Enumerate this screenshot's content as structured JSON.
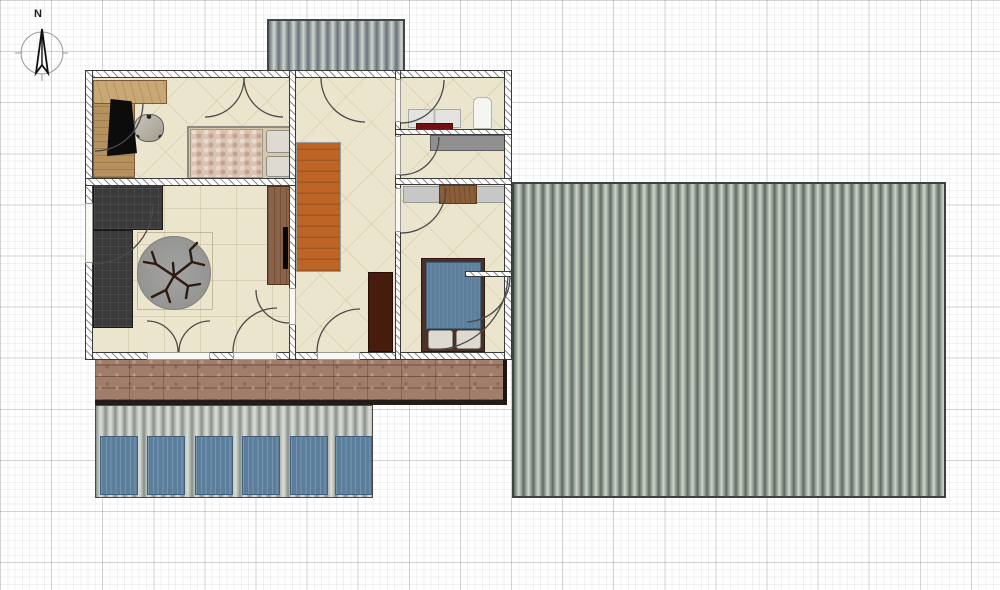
{
  "compass": {
    "north_label": "N"
  },
  "palette": {
    "grid_minor": "#ececec",
    "grid_major": "#d6d6d6",
    "floor": "#ece5cd",
    "wall_fill": "#ffffff",
    "wall_outline": "#3a3a3a",
    "roof_dark": "#5d6a64",
    "roof_light": "#cfd4c6",
    "deck_wood": "#a07e6b",
    "stairs_orange": "#bc6527",
    "sofa_charcoal": "#3b3b3b",
    "rug_gray": "#9a9a98",
    "bed1_mottle": "#d9c3b2",
    "bed2_blue": "#5d7f9b",
    "bed2_frame": "#4a3026",
    "wardrobe_brown": "#451c0e",
    "sideboard_brown": "#8b6349",
    "desk_tan": "#c9a876",
    "accent_dark_red": "#701014",
    "carport_panel_blue": "#5b7e9c"
  },
  "plan": {
    "structures": [
      {
        "name": "porch-roof-corrugated",
        "cls": "corrugated-a",
        "x": 267,
        "y": 19,
        "w": 138,
        "h": 54
      },
      {
        "name": "main-roof-corrugated",
        "cls": "corrugated-b",
        "x": 512,
        "y": 182,
        "w": 434,
        "h": 316
      },
      {
        "name": "deck-boards",
        "cls": "deck",
        "x": 95,
        "y": 358,
        "w": 412,
        "h": 47
      },
      {
        "name": "carport-roof-corrugated",
        "cls": "corrugated-c",
        "x": 95,
        "y": 405,
        "w": 278,
        "h": 93
      },
      {
        "name": "carport-panel",
        "cls": "blue-panel",
        "x": 100,
        "y": 436,
        "w": 38,
        "h": 59
      },
      {
        "name": "carport-panel",
        "cls": "blue-panel",
        "x": 147,
        "y": 436,
        "w": 38,
        "h": 59
      },
      {
        "name": "carport-panel",
        "cls": "blue-panel",
        "x": 195,
        "y": 436,
        "w": 38,
        "h": 59
      },
      {
        "name": "carport-panel",
        "cls": "blue-panel",
        "x": 242,
        "y": 436,
        "w": 38,
        "h": 59
      },
      {
        "name": "carport-panel",
        "cls": "blue-panel",
        "x": 290,
        "y": 436,
        "w": 38,
        "h": 59
      },
      {
        "name": "carport-panel",
        "cls": "blue-panel",
        "x": 335,
        "y": 436,
        "w": 37,
        "h": 59
      }
    ],
    "rooms": [
      {
        "name": "room-bedroom-office",
        "cls": "room room-diag",
        "x": 92,
        "y": 77,
        "w": 198,
        "h": 104
      },
      {
        "name": "room-living",
        "cls": "room room-grid",
        "x": 92,
        "y": 186,
        "w": 198,
        "h": 167
      },
      {
        "name": "room-hallway",
        "cls": "room room-diag",
        "x": 296,
        "y": 77,
        "w": 100,
        "h": 276
      },
      {
        "name": "room-bathroom",
        "cls": "room room-diag",
        "x": 401,
        "y": 77,
        "w": 104,
        "h": 53
      },
      {
        "name": "room-utility",
        "cls": "room room-diag",
        "x": 401,
        "y": 135,
        "w": 104,
        "h": 44
      },
      {
        "name": "room-bedroom-2",
        "cls": "room room-diag",
        "x": 401,
        "y": 184,
        "w": 104,
        "h": 169
      }
    ],
    "furniture": [
      {
        "name": "desk-return",
        "cls": "desk",
        "x": 93,
        "y": 80,
        "w": 42,
        "h": 98
      },
      {
        "name": "desk-top",
        "cls": "desk-light",
        "x": 93,
        "y": 80,
        "w": 74,
        "h": 24
      },
      {
        "name": "chair-mat",
        "cls": "mat",
        "x": 107,
        "y": 99,
        "w": 30,
        "h": 57
      },
      {
        "name": "office-chair",
        "cls": "chair",
        "x": 134,
        "y": 114,
        "w": 30,
        "h": 28
      },
      {
        "name": "bed-double-frame",
        "cls": "bed1",
        "x": 187,
        "y": 126,
        "w": 108,
        "h": 55
      },
      {
        "name": "bed-double-duvet",
        "cls": "mottle",
        "x": 190,
        "y": 129,
        "w": 73,
        "h": 49
      },
      {
        "name": "bed-pillow",
        "cls": "pillow",
        "x": 266,
        "y": 130,
        "w": 25,
        "h": 23
      },
      {
        "name": "bed-pillow",
        "cls": "pillow",
        "x": 266,
        "y": 156,
        "w": 25,
        "h": 21
      },
      {
        "name": "sofa-chaise",
        "cls": "sofa",
        "x": 93,
        "y": 182,
        "w": 70,
        "h": 48
      },
      {
        "name": "sofa-main",
        "cls": "sofa",
        "x": 93,
        "y": 230,
        "w": 40,
        "h": 98
      },
      {
        "name": "rug-border",
        "cls": "rug-square",
        "x": 137,
        "y": 232,
        "w": 76,
        "h": 78
      },
      {
        "name": "round-rug",
        "cls": "rug",
        "x": 137,
        "y": 236,
        "w": 74,
        "h": 74
      },
      {
        "name": "sideboard",
        "cls": "sideboard",
        "x": 267,
        "y": 186,
        "w": 23,
        "h": 99
      },
      {
        "name": "tv-screen",
        "cls": "tv",
        "x": 283,
        "y": 227,
        "w": 5,
        "h": 42
      },
      {
        "name": "staircase",
        "cls": "stairs",
        "x": 296,
        "y": 142,
        "w": 45,
        "h": 130
      },
      {
        "name": "wardrobe",
        "cls": "wardrobe",
        "x": 368,
        "y": 272,
        "w": 25,
        "h": 80
      },
      {
        "name": "vanity-cabinet",
        "cls": "vanity",
        "x": 408,
        "y": 109,
        "w": 53,
        "h": 19
      },
      {
        "name": "bath-mat-red",
        "cls": "red-accent",
        "x": 416,
        "y": 123,
        "w": 37,
        "h": 8
      },
      {
        "name": "shower-cabinet",
        "cls": "white-box",
        "x": 473,
        "y": 97,
        "w": 19,
        "h": 32
      },
      {
        "name": "utility-counter",
        "cls": "counter",
        "x": 430,
        "y": 135,
        "w": 77,
        "h": 16
      },
      {
        "name": "bedroom2-shelf",
        "cls": "shelf",
        "x": 403,
        "y": 186,
        "w": 104,
        "h": 17
      },
      {
        "name": "bedroom2-desk",
        "cls": "wood-box",
        "x": 439,
        "y": 185,
        "w": 38,
        "h": 19
      },
      {
        "name": "bed2-frame",
        "cls": "bed2-frame",
        "x": 421,
        "y": 258,
        "w": 64,
        "h": 94
      },
      {
        "name": "bed2-mattress",
        "cls": "bed2-mattress",
        "x": 426,
        "y": 262,
        "w": 55,
        "h": 67
      },
      {
        "name": "bed-pillow",
        "cls": "pillow",
        "x": 428,
        "y": 330,
        "w": 25,
        "h": 19
      },
      {
        "name": "bed-pillow",
        "cls": "pillow",
        "x": 456,
        "y": 330,
        "w": 25,
        "h": 19
      }
    ],
    "walls": [
      {
        "name": "wall-north",
        "cls": "wall",
        "x": 85,
        "y": 70,
        "w": 427,
        "h": 8
      },
      {
        "name": "wall-south",
        "cls": "wall",
        "x": 85,
        "y": 352,
        "w": 427,
        "h": 8
      },
      {
        "name": "wall-west",
        "cls": "wall",
        "x": 85,
        "y": 70,
        "w": 8,
        "h": 290
      },
      {
        "name": "wall-east",
        "cls": "wall",
        "x": 504,
        "y": 70,
        "w": 8,
        "h": 290
      },
      {
        "name": "wall-mid-left",
        "cls": "wall",
        "x": 289,
        "y": 70,
        "w": 7,
        "h": 290
      },
      {
        "name": "wall-mid-right",
        "cls": "wall",
        "x": 395,
        "y": 70,
        "w": 6,
        "h": 290
      },
      {
        "name": "wall-bedroom-living",
        "cls": "wall",
        "x": 85,
        "y": 178,
        "w": 211,
        "h": 8
      },
      {
        "name": "wall-bathroom",
        "cls": "wall",
        "x": 395,
        "y": 129,
        "w": 117,
        "h": 6
      },
      {
        "name": "wall-utility",
        "cls": "wall",
        "x": 395,
        "y": 178,
        "w": 117,
        "h": 7
      },
      {
        "name": "wall-closet-stub",
        "cls": "wall",
        "x": 465,
        "y": 271,
        "w": 47,
        "h": 6
      }
    ],
    "openings": [
      {
        "name": "door-opening-living-west",
        "cls": "opening",
        "x": 85,
        "y": 203,
        "w": 8,
        "h": 60
      },
      {
        "name": "door-opening-living-hall",
        "cls": "opening",
        "x": 289,
        "y": 288,
        "w": 7,
        "h": 37
      },
      {
        "name": "door-opening-bathroom",
        "cls": "opening",
        "x": 395,
        "y": 79,
        "w": 6,
        "h": 43
      },
      {
        "name": "door-opening-utility",
        "cls": "opening",
        "x": 395,
        "y": 136,
        "w": 6,
        "h": 39
      },
      {
        "name": "door-opening-bedroom2",
        "cls": "opening",
        "x": 395,
        "y": 188,
        "w": 6,
        "h": 44
      },
      {
        "name": "door-opening-french",
        "cls": "opening",
        "x": 147,
        "y": 352,
        "w": 63,
        "h": 8
      },
      {
        "name": "door-opening-living-south",
        "cls": "opening",
        "x": 233,
        "y": 352,
        "w": 44,
        "h": 8
      },
      {
        "name": "door-opening-entry",
        "cls": "opening",
        "x": 317,
        "y": 352,
        "w": 43,
        "h": 8
      }
    ],
    "doors": [
      {
        "name": "door-arc-office-west",
        "cls": "door-arc",
        "path": "M95,151 A48,48 0 0 0 143,103"
      },
      {
        "name": "door-arc-closet-left",
        "cls": "door-arc",
        "path": "M244,78 A39,39 0 0 1 205,117"
      },
      {
        "name": "door-arc-closet-right",
        "cls": "door-arc",
        "path": "M244,78 A39,39 0 0 0 283,117"
      },
      {
        "name": "door-arc-front-entry",
        "cls": "door-arc",
        "path": "M321,78 A44,44 0 0 0 365,122"
      },
      {
        "name": "door-arc-bathroom",
        "cls": "door-arc",
        "path": "M401,123 A43,43 0 0 0 444,80"
      },
      {
        "name": "door-arc-utility",
        "cls": "door-arc",
        "path": "M401,175 A38,38 0 0 0 439,137"
      },
      {
        "name": "door-arc-bedroom2",
        "cls": "door-arc",
        "path": "M401,233 A45,45 0 0 0 446,188"
      },
      {
        "name": "door-arc-closet2-small",
        "cls": "door-arc",
        "path": "M467,322 A45,45 0 0 0 510,277"
      },
      {
        "name": "door-arc-closet2-large",
        "cls": "door-arc",
        "path": "M432,350 A76,76 0 0 0 508,276"
      },
      {
        "name": "door-arc-living-west",
        "cls": "door-arc",
        "path": "M93,264 A60,60 0 0 0 153,204"
      },
      {
        "name": "door-arc-french-left",
        "cls": "door-arc",
        "path": "M178,352 A31,31 0 0 0 147,321"
      },
      {
        "name": "door-arc-french-right",
        "cls": "door-arc",
        "path": "M179,352 A31,31 0 0 1 210,321"
      },
      {
        "name": "door-arc-living-south",
        "cls": "door-arc",
        "path": "M233,352 A44,44 0 0 1 277,308"
      },
      {
        "name": "door-arc-hall-entry",
        "cls": "door-arc",
        "path": "M317,352 A43,43 0 0 1 360,309"
      },
      {
        "name": "door-arc-living-hall",
        "cls": "door-arc",
        "path": "M256,290 A33,33 0 0 0 289,323"
      }
    ],
    "decor": [
      {
        "name": "plant-branches-icon",
        "cls": "branch",
        "path": "M174,276 L156,264 L144,262 M156,264 L152,252"
      },
      {
        "name": "plant-branches-icon",
        "cls": "branch",
        "path": "M174,276 L192,262 L204,265 M192,262 L190,250 L197,243"
      },
      {
        "name": "plant-branches-icon",
        "cls": "branch",
        "path": "M174,276 L166,290 L152,297 M166,290 L170,302"
      },
      {
        "name": "plant-branches-icon",
        "cls": "branch",
        "path": "M174,276 L188,286 L200,284 M188,286 L186,298"
      },
      {
        "name": "plant-branches-icon",
        "cls": "branch",
        "path": "M174,276 L173,263"
      }
    ]
  }
}
